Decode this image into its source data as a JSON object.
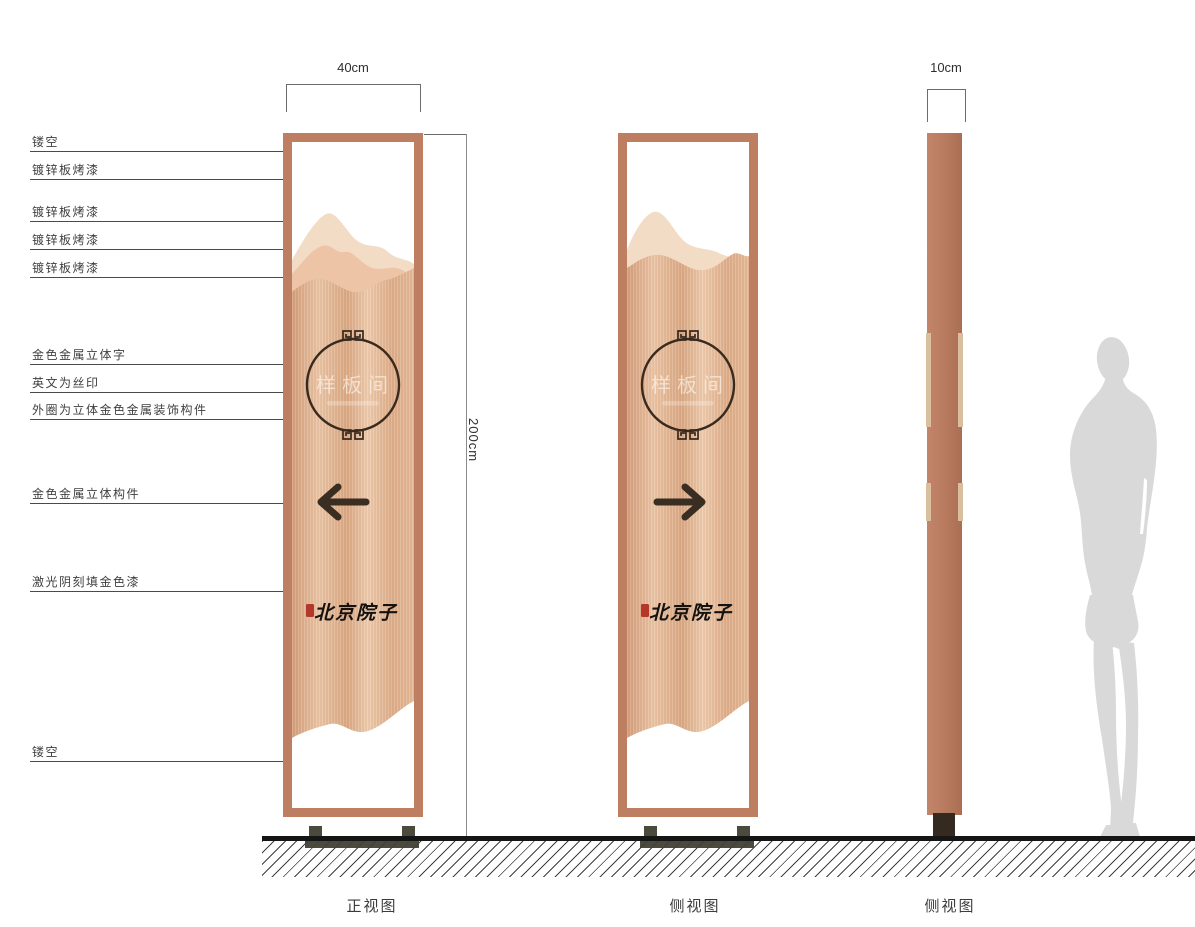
{
  "dimensions": {
    "front_width": "40cm",
    "side_width": "10cm",
    "height": "200cm"
  },
  "captions": {
    "front": "正视图",
    "middle": "侧视图",
    "side": "侧视图"
  },
  "sign": {
    "room_label": "样板间",
    "brand": "北京院子"
  },
  "annotations": [
    {
      "label": "镂空"
    },
    {
      "label": "镀锌板烤漆"
    },
    {
      "label": "镀锌板烤漆"
    },
    {
      "label": "镀锌板烤漆"
    },
    {
      "label": "镀锌板烤漆"
    },
    {
      "label": "金色金属立体字"
    },
    {
      "label": "英文为丝印"
    },
    {
      "label": "外圈为立体金色金属装饰构件"
    },
    {
      "label": "金色金属立体构件"
    },
    {
      "label": "激光阴刻填金色漆"
    },
    {
      "label": "镂空"
    }
  ],
  "colors": {
    "frame": "#bd7e62",
    "mountain_back": "#f3dcc6",
    "mountain_mid": "#eec4a7",
    "copper_dark": "#d29c79",
    "copper_light": "#ecc9ab",
    "circle_stroke": "#3a2a1e",
    "arrow": "#3a2d21",
    "base": "#4b4a3d",
    "seal_red": "#b5372a",
    "side_strip": "#d9bf9e",
    "silhouette": "#d9d9d9",
    "ground": "#151515"
  }
}
